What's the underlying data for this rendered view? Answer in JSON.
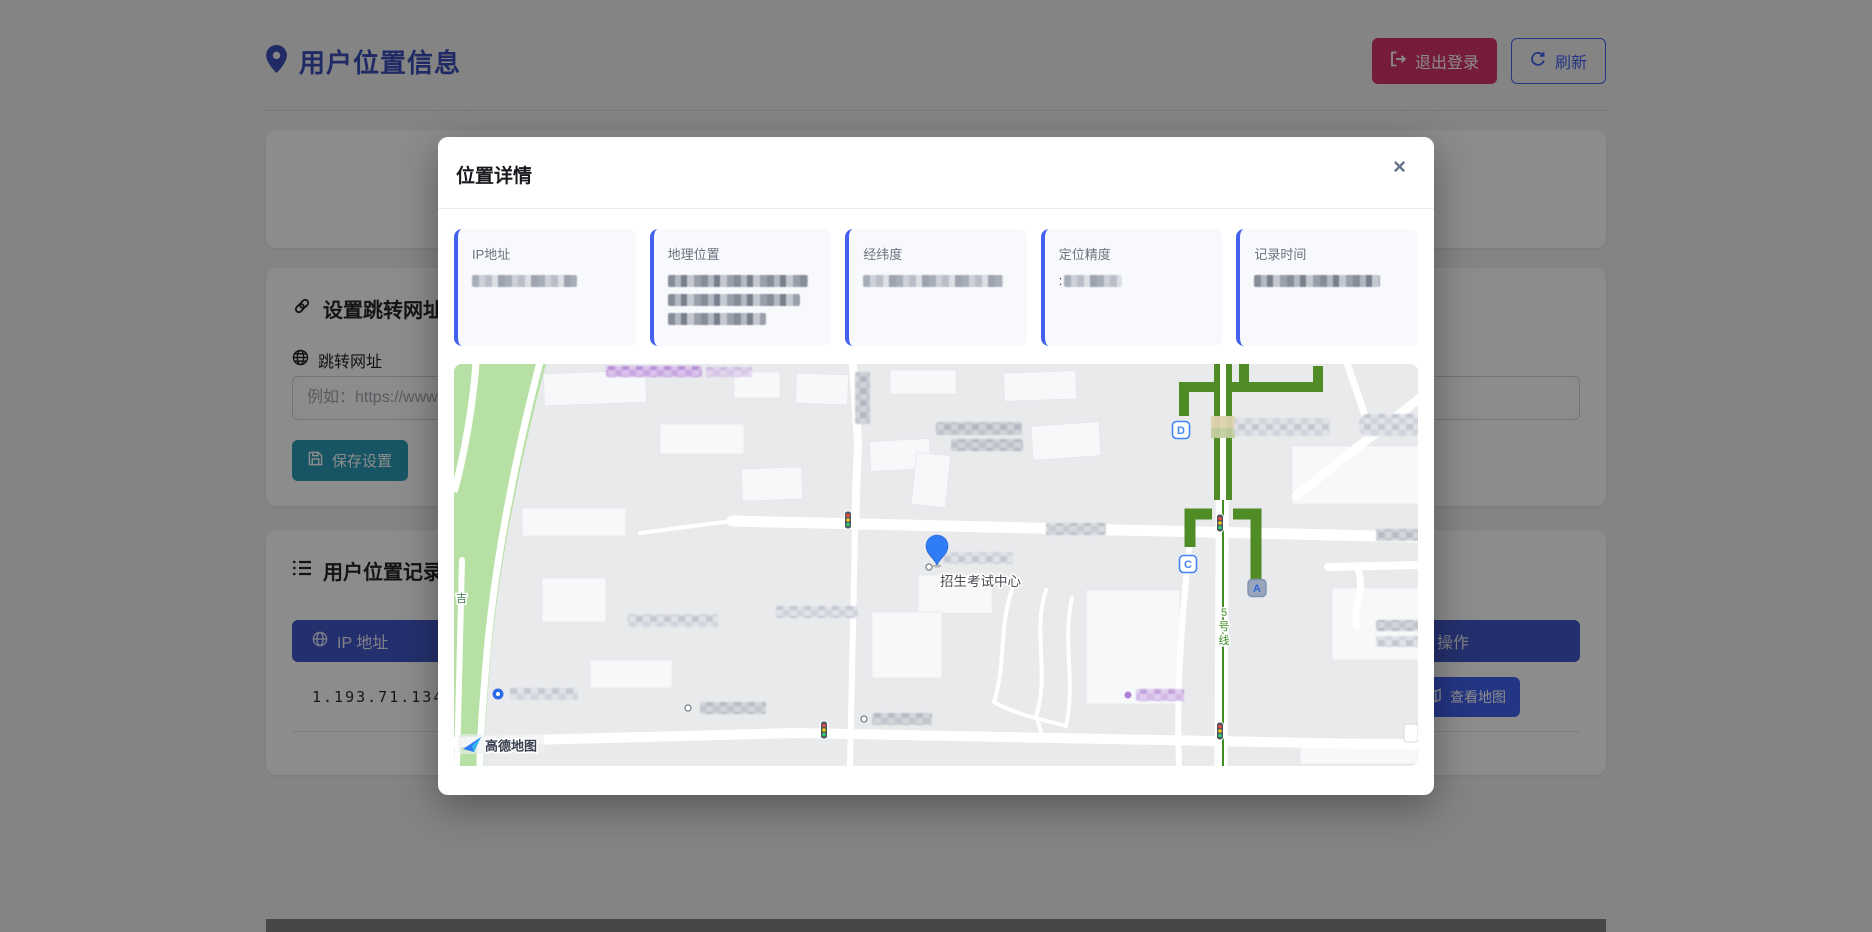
{
  "page": {
    "title": "用户位置信息",
    "logout_button": "退出登录",
    "refresh_button": "刷新",
    "settings": {
      "heading": "设置跳转网址",
      "url_label": "跳转网址",
      "url_placeholder": "例如：https://www.",
      "save_button": "保存设置"
    },
    "records": {
      "heading": "用户位置记录",
      "col_ip": "IP 地址",
      "col_action": "操作",
      "rows": [
        {
          "ip": "1.193.71.134",
          "action_button": "查看地图"
        }
      ]
    }
  },
  "modal": {
    "title": "位置详情",
    "close": "×",
    "info_cards": [
      {
        "label": "IP地址",
        "value_censored": true
      },
      {
        "label": "地理位置",
        "value_censored": true
      },
      {
        "label": "经纬度",
        "value_censored": true
      },
      {
        "label": "定位精度",
        "value_censored": true,
        "visible_prefix": ":"
      },
      {
        "label": "记录时间",
        "value_censored": true
      }
    ],
    "map": {
      "poi_label": "招生考试中心",
      "metro_line_chars": [
        "5",
        "号",
        "线"
      ],
      "road_label": "吉",
      "station_exits": {
        "a": "A",
        "c": "C",
        "d": "D"
      },
      "provider_logo": "高德地图"
    }
  },
  "colors": {
    "accent_blue": "#4361ee",
    "title_indigo": "#3b4db8",
    "logout_crimson": "#d6336c",
    "save_teal": "#2b9cb6",
    "table_header_blue": "#4358c9",
    "metro_green": "#4f8c26",
    "marker_blue": "#2f7cf6"
  }
}
